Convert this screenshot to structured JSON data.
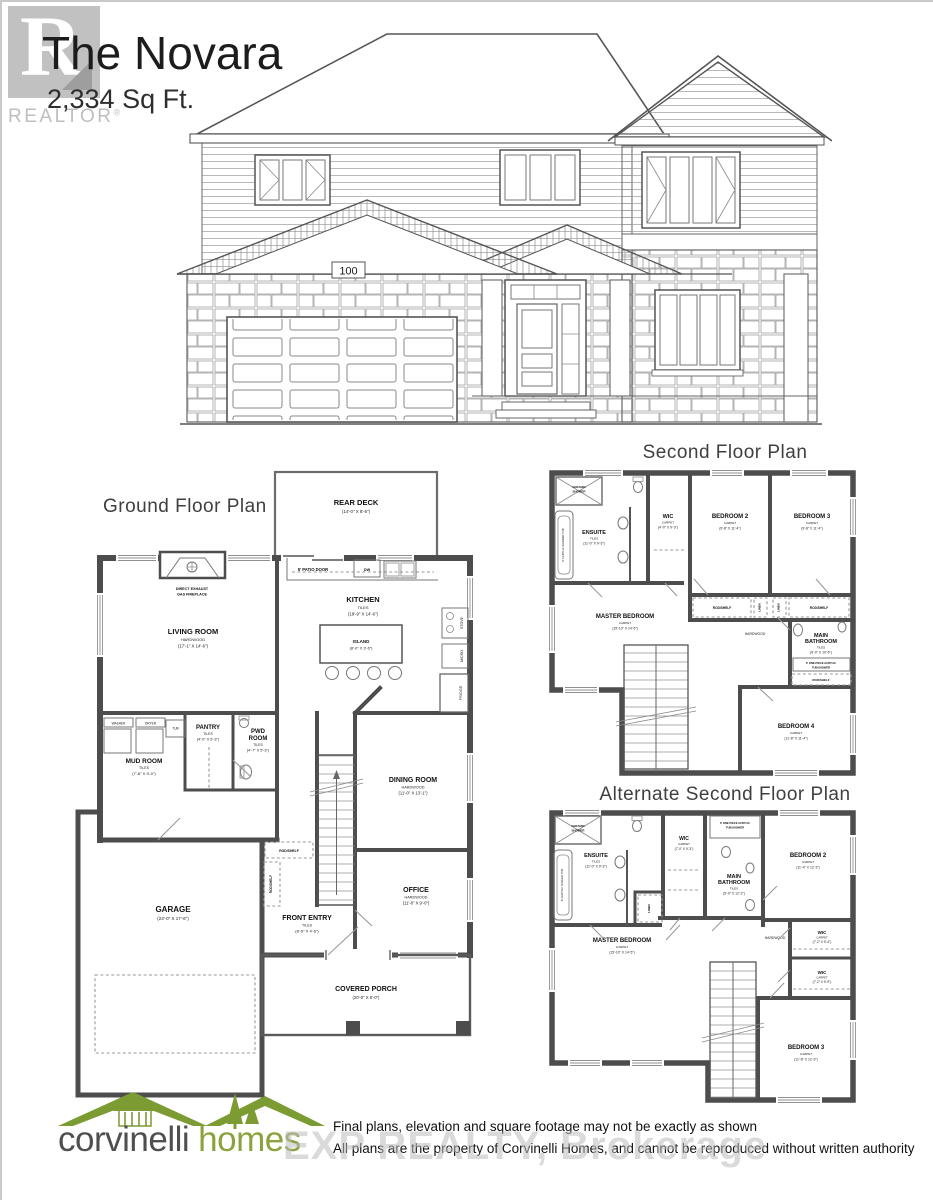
{
  "page": {
    "title": "The Novara",
    "sqft": "2,334 Sq Ft.",
    "plaque": "100",
    "realtor_letter": "R",
    "realtor_label": "REALTOR",
    "reg_mark": "®",
    "exp_watermark": "EXP REALTY, Brokerage"
  },
  "ground": {
    "title": "Ground Floor Plan",
    "rear_deck": {
      "name": "REAR DECK",
      "dims": "(14'-0\" X 8'-6\")"
    },
    "patio_door": "5' PATIO DOOR",
    "fireplace1": "DIRECT EXHAUST",
    "fireplace2": "GAS FIREPLACE",
    "living": {
      "name": "LIVING ROOM",
      "finish": "HARDWOOD",
      "dims": "(17'-1\" X 14'-6\")"
    },
    "kitchen": {
      "name": "KITCHEN",
      "finish": "TILES",
      "dims": "(18'-9\" X 14'-6\")"
    },
    "island": {
      "name": "ISLAND",
      "dims": "(8'-0\" X 3'-6\")"
    },
    "dw": "DW",
    "stove": "STOVE",
    "micro": "MICRO",
    "fridge": "FRIDGE",
    "washer": "WASHER",
    "dryer": "DRYER",
    "tub": "TUB",
    "mud": {
      "name": "MUD ROOM",
      "finish": "TILES",
      "dims": "(7'-8\" X 9'-0\")"
    },
    "pantry": {
      "name": "PANTRY",
      "finish": "TILES",
      "dims": "(4'-0\" X 5'-3\")"
    },
    "pwd": {
      "name1": "PWD",
      "name2": "ROOM",
      "finish": "TILES",
      "dims": "(4'-7\" X 5'-3\")"
    },
    "rod_shelf": "ROD/SHELF",
    "garage": {
      "name": "GARAGE",
      "dims": "(23'-0\" X 17'-6\")"
    },
    "entry": {
      "name": "FRONT ENTRY",
      "finish": "TILES",
      "dims": "(8'-5\" X 4'-6\")"
    },
    "dining": {
      "name": "DINING ROOM",
      "finish": "HARDWOOD",
      "dims": "(11'-0\" X 13'-1\")"
    },
    "office": {
      "name": "OFFICE",
      "finish": "HARDWOOD",
      "dims": "(11'-8\" X 9'-0\")"
    },
    "porch": {
      "name": "COVERED PORCH",
      "dims": "(20'-0\" X 6'-0\")"
    }
  },
  "second": {
    "title": "Second Floor Plan",
    "shower1": "CERAMIC",
    "shower2": "SHOWER",
    "tub_label": "6' ACRYLIC SHOWER TUB",
    "ensuite": {
      "name": "ENSUITE",
      "finish": "TILES",
      "dims": "(11'-0\" X 9'-3\")"
    },
    "wic": {
      "name": "WIC",
      "finish": "CARPET",
      "dims": "(4'-0\" X 9'-3\")"
    },
    "bed2": {
      "name": "BEDROOM 2",
      "finish": "CARPET",
      "dims": "(9'-8\" X 11'-4\")"
    },
    "bed3": {
      "name": "BEDROOM 3",
      "finish": "CARPET",
      "dims": "(9'-8\" X 11'-4\")"
    },
    "master": {
      "name": "MASTER BEDROOM",
      "finish": "CARPET",
      "dims": "(15'-10\" X 14'-5\")"
    },
    "rod_shelf": "ROD/SHELF",
    "linen": "LINEN",
    "hardwood": "HARDWOOD",
    "bath": {
      "name1": "MAIN",
      "name2": "BATHROOM",
      "finish": "TILES",
      "dims": "(6'-0\" X 10'-6\")"
    },
    "onepiece1": "6' ONE PIECE ACRYLIC",
    "onepiece2": "TUB/SHOWER",
    "bed4": {
      "name": "BEDROOM 4",
      "finish": "CARPET",
      "dims": "(11'-8\" X 11'-4\")"
    }
  },
  "alternate": {
    "title": "Alternate Second Floor Plan",
    "shower1": "CERAMIC",
    "shower2": "SHOWER",
    "tub_label": "6' ACRYLIC SOAKER TUB",
    "ensuite": {
      "name": "ENSUITE",
      "finish": "TILES",
      "dims": "(11'-0\" X 9'-3\")"
    },
    "wic1": {
      "name": "WIC",
      "finish": "CARPET",
      "dims": "(7'-0\" X 9'-3\")"
    },
    "onepiece1": "6' ONE PIECE ACRYLIC",
    "onepiece2": "TUB/SHOWER",
    "bath": {
      "name1": "MAIN",
      "name2": "BATHROOM",
      "finish": "TILES",
      "dims": "(5'-0\" X 12'-2\")"
    },
    "bed2": {
      "name": "BEDROOM 2",
      "finish": "CARPET",
      "dims": "(11'-4\" X 12'-3\")"
    },
    "master": {
      "name": "MASTER BEDROOM",
      "finish": "CARPET",
      "dims": "(15'-10\" X 14'-5\")"
    },
    "linen": "LINEN",
    "hardwood": "HARDWOOD",
    "wic2": {
      "name": "WIC",
      "finish": "CARPET",
      "dims": "(7'-2\" X 5'-4\")"
    },
    "wic3": {
      "name": "WIC",
      "finish": "CARPET",
      "dims": "(7'-2\" X 5'-9\")"
    },
    "bed3": {
      "name": "BEDROOM 3",
      "finish": "CARPET",
      "dims": "(11'-8\" X 12'-3\")"
    }
  },
  "footer": {
    "brand1": "corvinelli",
    "brand2": "homes",
    "disclaimer1": "Final plans, elevation and square footage may not be exactly as shown",
    "disclaimer2": "All plans are the property of Corvinelli Homes, and cannot be reproduced without written authority"
  },
  "colors": {
    "brand_green": "#7d9b33",
    "line_dark": "#4d4d4d",
    "watermark_gray": "#bdbdbd"
  }
}
